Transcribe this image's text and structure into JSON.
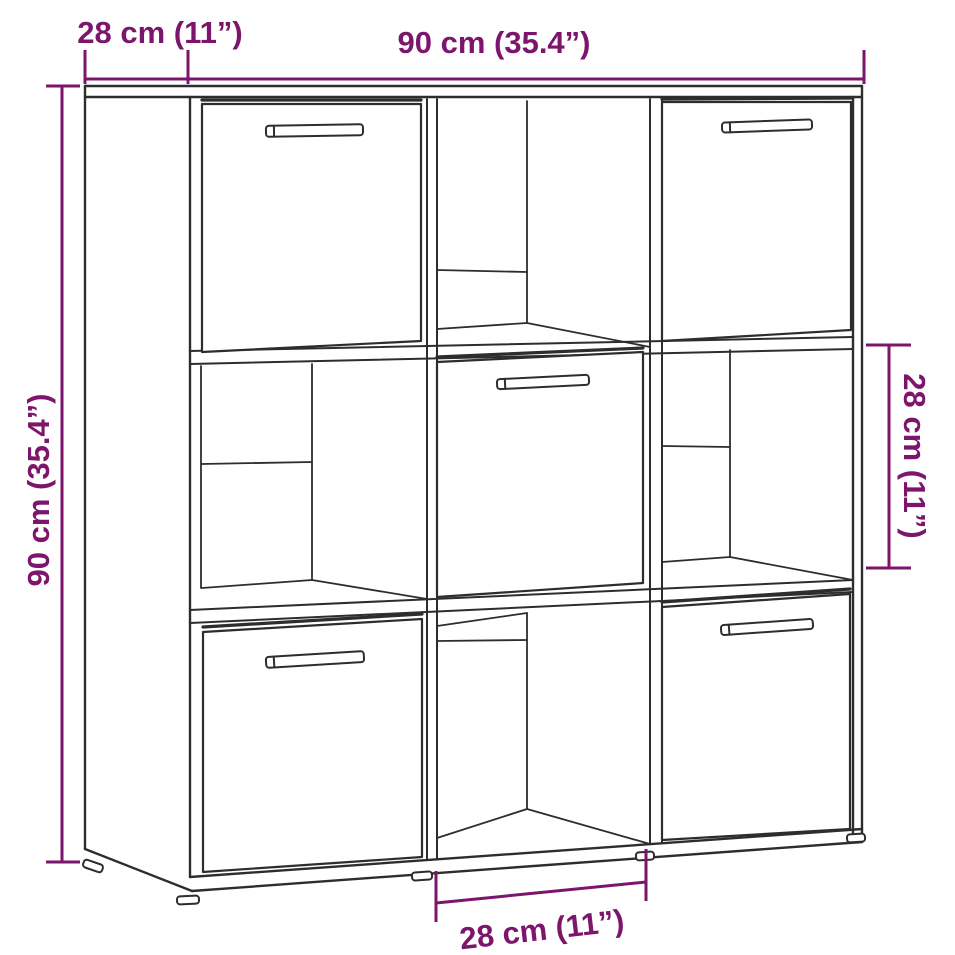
{
  "figure": {
    "annotations": {
      "top_depth": "28 cm (11”)",
      "top_width": "90 cm (35.4”)",
      "side_height": "90 cm (35.4”)",
      "cube_height": "28 cm (11”)",
      "cube_width": "28 cm (11”)"
    },
    "colors": {
      "dimension_accent": "#7C156B",
      "line_art": "#2D2D2D",
      "background": "#FFFFFF"
    }
  }
}
